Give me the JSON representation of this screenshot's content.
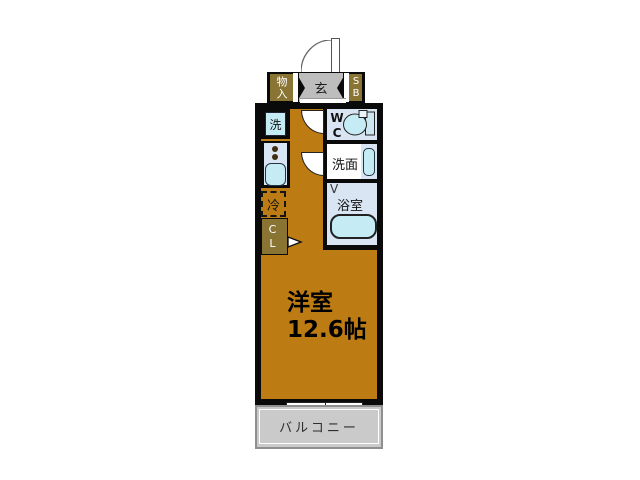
{
  "plan": {
    "type": "floor-plan",
    "colors": {
      "wall": "#0a0a0a",
      "floor": "#bd7b14",
      "storage_olive": "#8a7434",
      "entry_gray": "#bdbdbd",
      "room_blue": "#d9e5f2",
      "fixture_cyan": "#c5ecf5",
      "balcony_gray": "#cacaca"
    },
    "labels": {
      "storage": "物入",
      "entrance": "玄",
      "shoe_box": "SB",
      "washer": "洗",
      "wc": "WC",
      "washroom": "洗面",
      "bathroom": "浴室",
      "bath_door_mark": "V",
      "fridge": "冷",
      "closet": "CL",
      "main_room_name": "洋室",
      "main_room_size": "12.6帖",
      "balcony": "バルコニー"
    }
  }
}
